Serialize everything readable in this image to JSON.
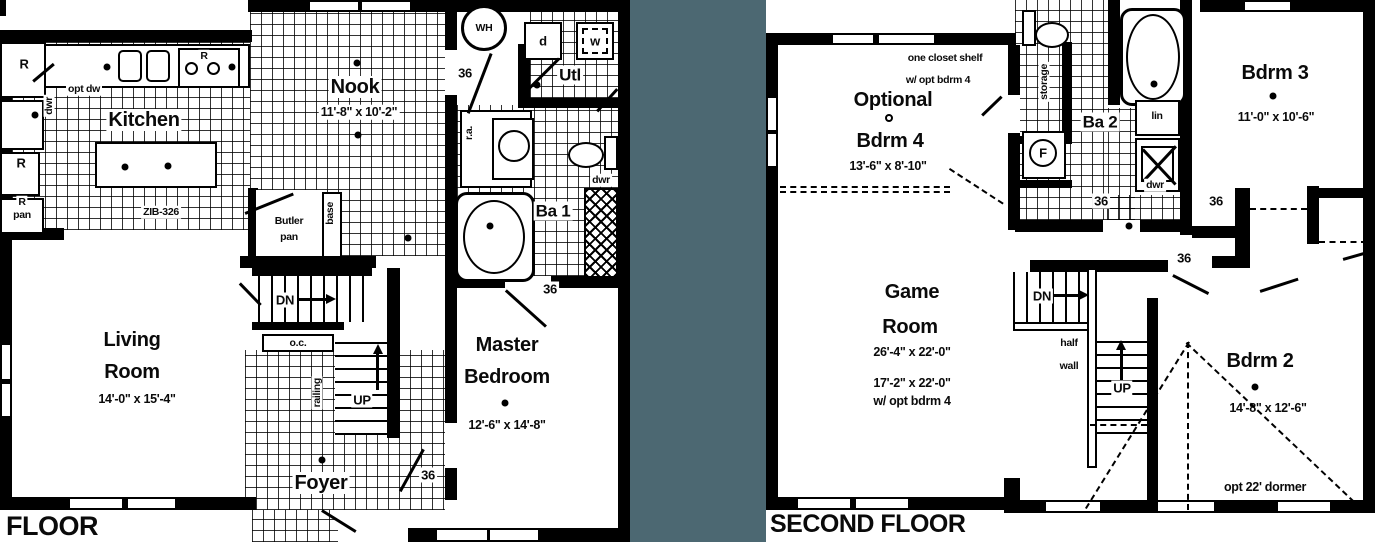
{
  "colors": {
    "background": "#4c6872",
    "plan": "#ffffff",
    "wall": "#000000"
  },
  "first_floor": {
    "title": "FLOOR",
    "kitchen": {
      "name": "Kitchen",
      "island_model": "ZIB-326",
      "opt_dw": "opt dw",
      "dwr": "dwr",
      "r_top": "R",
      "r_fridge": "R",
      "r_side": "R",
      "r_pan1": "R",
      "r_pan2": "pan"
    },
    "nook": {
      "name": "Nook",
      "dims": "11'-8\" x 10'-2\""
    },
    "utility": {
      "name": "Utl",
      "washer": "w",
      "dryer": "d",
      "water_heater": "WH"
    },
    "bath1": {
      "name": "Ba 1",
      "ra": "r.a.",
      "dwr": "dwr"
    },
    "living": {
      "line1": "Living",
      "line2": "Room",
      "dims": "14'-0\" x 15'-4\""
    },
    "master": {
      "line1": "Master",
      "line2": "Bedroom",
      "dims": "12'-6\" x 14'-8\""
    },
    "foyer": {
      "name": "Foyer"
    },
    "butler": {
      "line1": "Butler",
      "line2": "pan",
      "base": "base"
    },
    "stairs": {
      "dn": "DN",
      "up": "UP",
      "oc": "o.c.",
      "railing": "railing"
    },
    "doors": {
      "a": "36",
      "b": "36",
      "c": "36"
    }
  },
  "second_floor": {
    "title": "SECOND FLOOR",
    "optional": {
      "note1": "one closet shelf",
      "note2": "w/ opt bdrm 4",
      "line1": "Optional",
      "line2": "Bdrm 4",
      "dims": "13'-6\" x 8'-10\""
    },
    "storage_label": "storage",
    "bath2": {
      "name": "Ba 2",
      "lin": "lin",
      "dwr": "dwr",
      "furnace": "F"
    },
    "bdrm3": {
      "name": "Bdrm 3",
      "dims": "11'-0\" x 10'-6\""
    },
    "game": {
      "line1": "Game",
      "line2": "Room",
      "dims1": "26'-4\" x 22'-0\"",
      "dims2": "17'-2\" x 22'-0\"",
      "dims3": "w/ opt bdrm 4"
    },
    "bdrm2": {
      "name": "Bdrm 2",
      "dims": "14'-8\" x 12'-6\"",
      "dormer": "opt 22' dormer"
    },
    "stairs": {
      "dn": "DN",
      "up": "UP",
      "half1": "half",
      "half2": "wall"
    },
    "doors": {
      "a": "36",
      "b": "36",
      "c": "36"
    }
  }
}
